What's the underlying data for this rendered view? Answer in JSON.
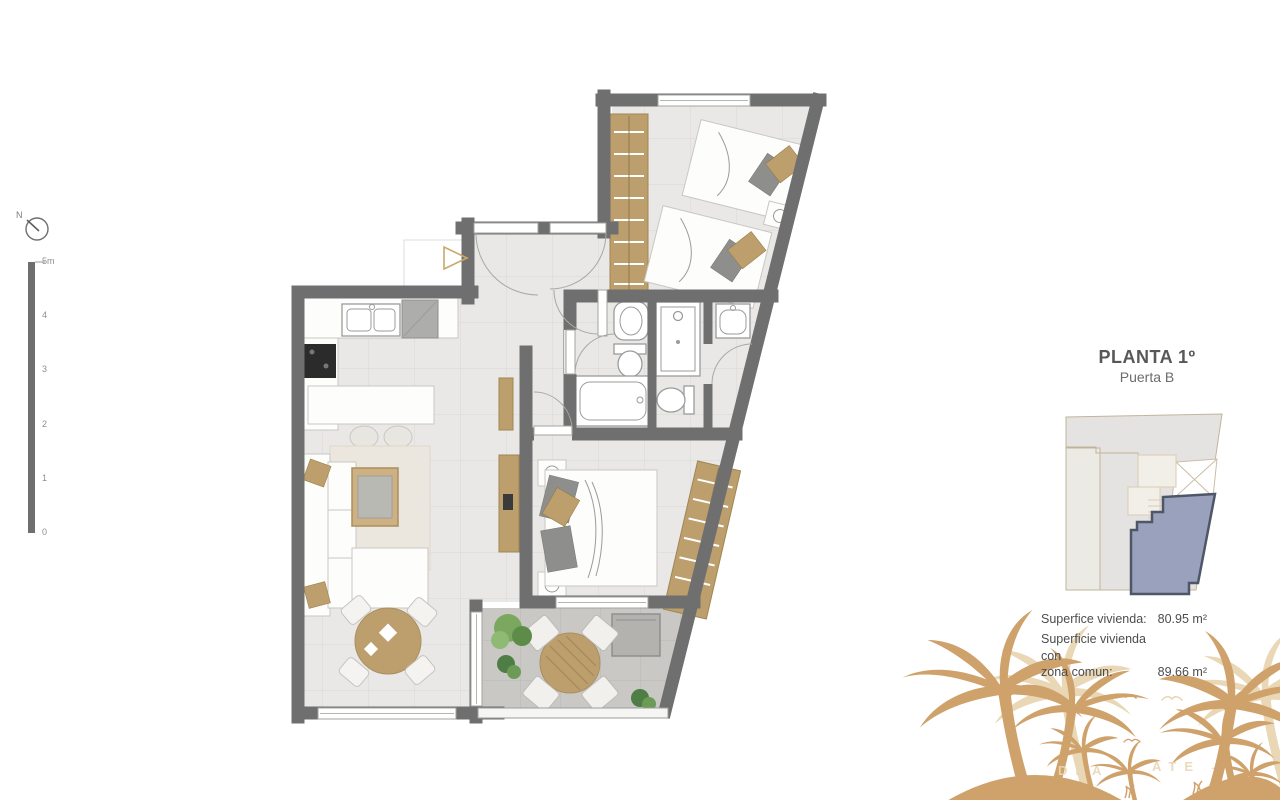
{
  "compass": {
    "label": "N"
  },
  "scalebar": {
    "ticks": [
      "5m",
      "4",
      "3",
      "2",
      "1",
      "0"
    ]
  },
  "info_panel": {
    "title": "PLANTA 1º",
    "subtitle": "Puerta B",
    "area_rows": [
      {
        "label": "Superfice vivienda:",
        "value": "80.95 m²"
      },
      {
        "label": "Superficie vivienda con\nzona comun:",
        "value": "89.66 m²"
      }
    ]
  },
  "decor": {
    "watermark_left": "DEA",
    "watermark_right": "ATE"
  },
  "colors": {
    "wall": "#6f6f6f",
    "floor": "#e9e8e6",
    "floor_line": "#d9d7d4",
    "terrace": "#c9c8c5",
    "terrace_line": "#b8b7b4",
    "wood": "#bd9e6d",
    "wood_dark": "#a08751",
    "gold": "#c9a96a",
    "fixture_line": "#9b9b9b",
    "unit_fill": "#99a1bc",
    "unit_outline": "#4e5768",
    "keyplan_fill": "#e4e3e1",
    "keyplan_line": "#c2b49c",
    "palm": "#cfa26c",
    "palm_faint": "#e9d7b5",
    "text_dark": "#57585a",
    "text_mid": "#6b6c6e"
  }
}
